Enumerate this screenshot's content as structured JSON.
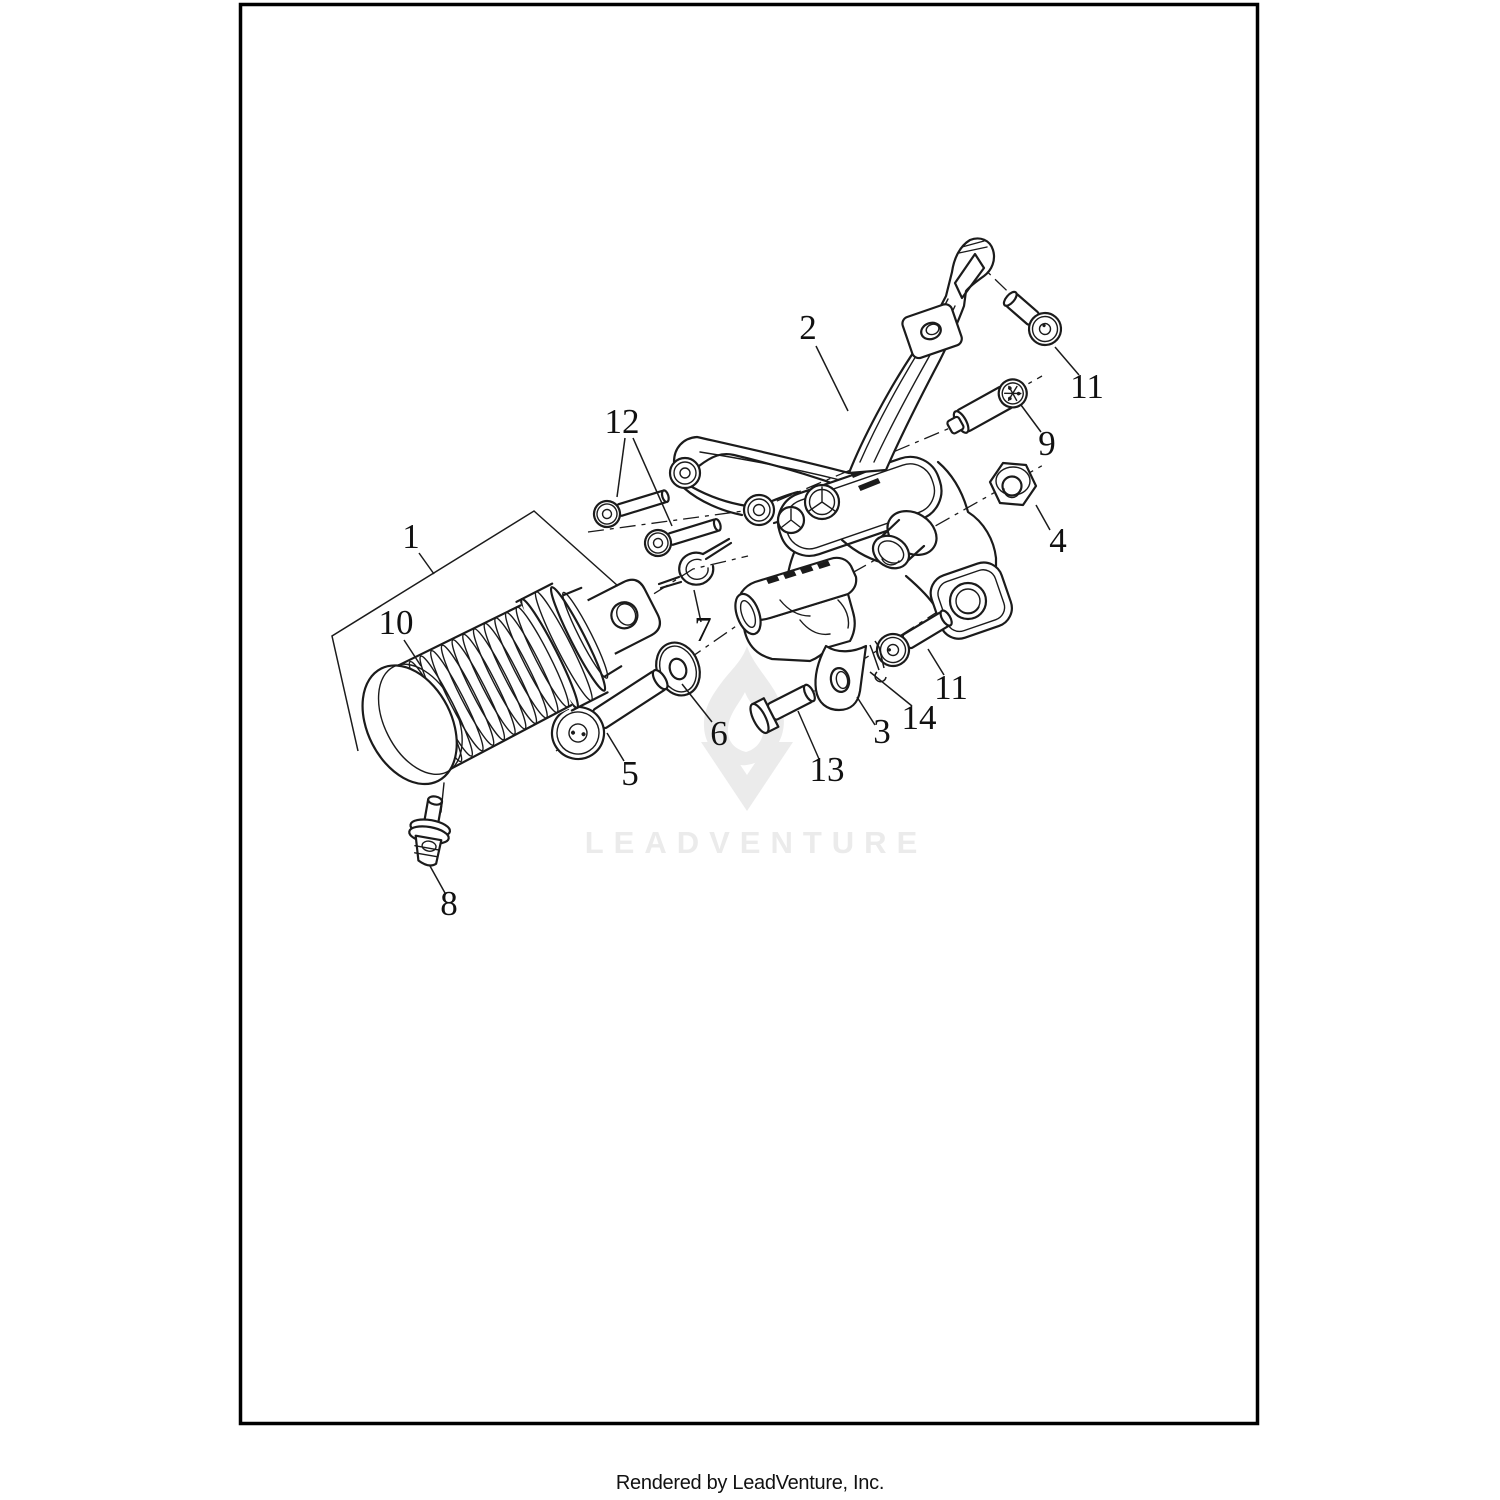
{
  "document": {
    "watermark_text": "LEADVENTURE",
    "caption": "Rendered by LeadVenture, Inc.",
    "colors": {
      "line": "#1b1b1b",
      "watermark": "#ebebeb",
      "background": "#ffffff",
      "frame_border": "#000000"
    }
  },
  "diagram": {
    "type": "exploded-parts-diagram",
    "subject": "Footrest support / footpeg assembly",
    "callouts": [
      {
        "number": "1",
        "points_to": "footpeg-assembly"
      },
      {
        "number": "2",
        "points_to": "footrest-support-bracket"
      },
      {
        "number": "3",
        "points_to": "footpeg-mount"
      },
      {
        "number": "4",
        "points_to": "flange-nut"
      },
      {
        "number": "5",
        "points_to": "socket-head-bolt"
      },
      {
        "number": "6",
        "points_to": "flat-washer"
      },
      {
        "number": "7",
        "points_to": "spring-clip"
      },
      {
        "number": "8",
        "points_to": "footpeg-mount-pin"
      },
      {
        "number": "9",
        "points_to": "grooved-dowel-pin"
      },
      {
        "number": "10",
        "points_to": "footpeg-rubber"
      },
      {
        "number": "11",
        "points_to": "button-head-screw-upper"
      },
      {
        "number": "11",
        "points_to": "button-head-screw-lower"
      },
      {
        "number": "12",
        "points_to": "socket-screw-pair"
      },
      {
        "number": "13",
        "points_to": "clevis-pin"
      },
      {
        "number": "14",
        "points_to": "cotter-pin"
      }
    ]
  }
}
